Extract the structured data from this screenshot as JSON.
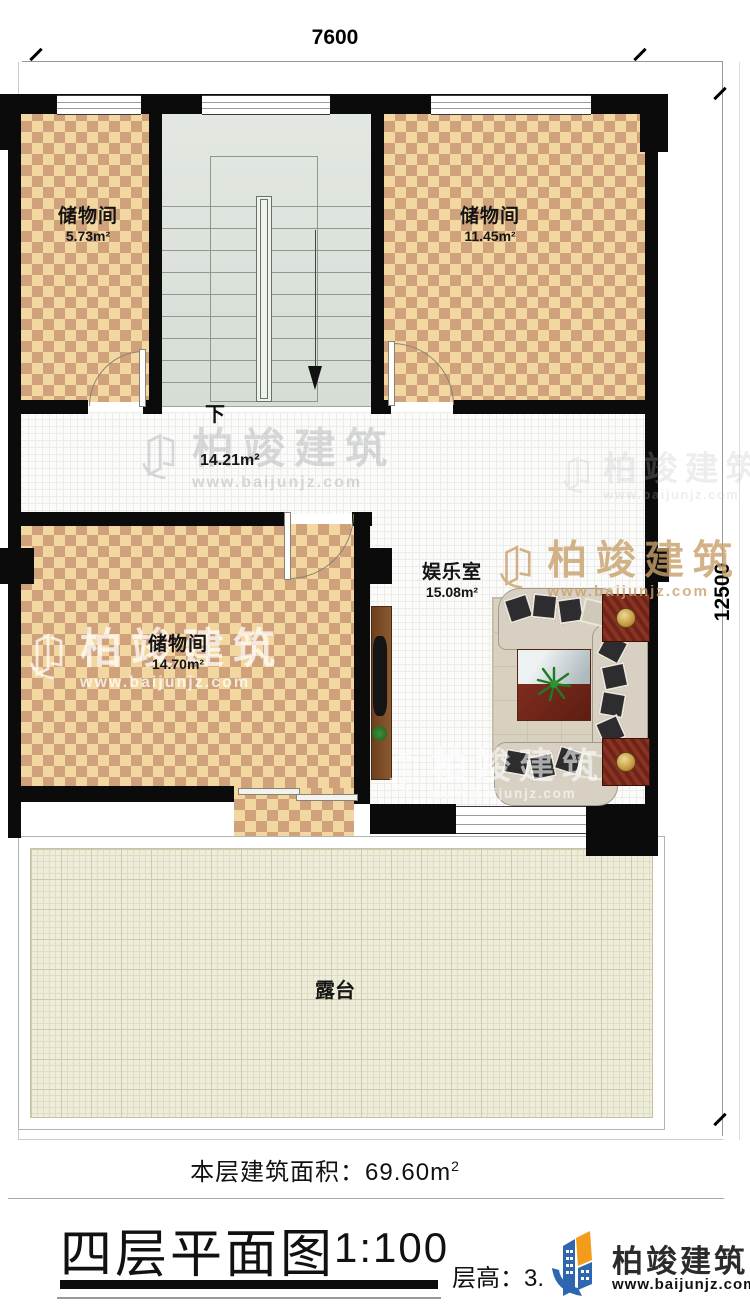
{
  "dimensions": {
    "top": "7600",
    "right": "12500"
  },
  "rooms": {
    "storage_top_left": {
      "name": "储物间",
      "area": "5.73m²"
    },
    "storage_top_right": {
      "name": "储物间",
      "area": "11.45m²"
    },
    "storage_bottom": {
      "name": "储物间",
      "area": "14.70m²"
    },
    "entertainment": {
      "name": "娱乐室",
      "area": "15.08m²"
    },
    "hallway": {
      "area": "14.21m²"
    },
    "terrace": {
      "name": "露台"
    }
  },
  "stairs": {
    "down_label": "下"
  },
  "footer": {
    "floor_area_label": "本层建筑面积：69.60m",
    "floor_area_sup": "2",
    "title": "四层平面图",
    "scale": "1:100",
    "floor_height": "层高：3.",
    "logo_name": "柏竣建筑",
    "logo_url": "www.baijunjz.com"
  },
  "watermark": {
    "name": "柏竣建筑",
    "url": "www.baijunjz.com"
  },
  "colors": {
    "wall": "#0b0b0b",
    "checker_light": "#f3d7a0",
    "checker_dark": "#cfa27b",
    "stair_floor": "#dde3dc",
    "terrace_floor": "#eeeddc",
    "accent_wood": "#7e2d1f",
    "logo_blue": "#2e66b0",
    "logo_orange": "#f39c1c"
  }
}
